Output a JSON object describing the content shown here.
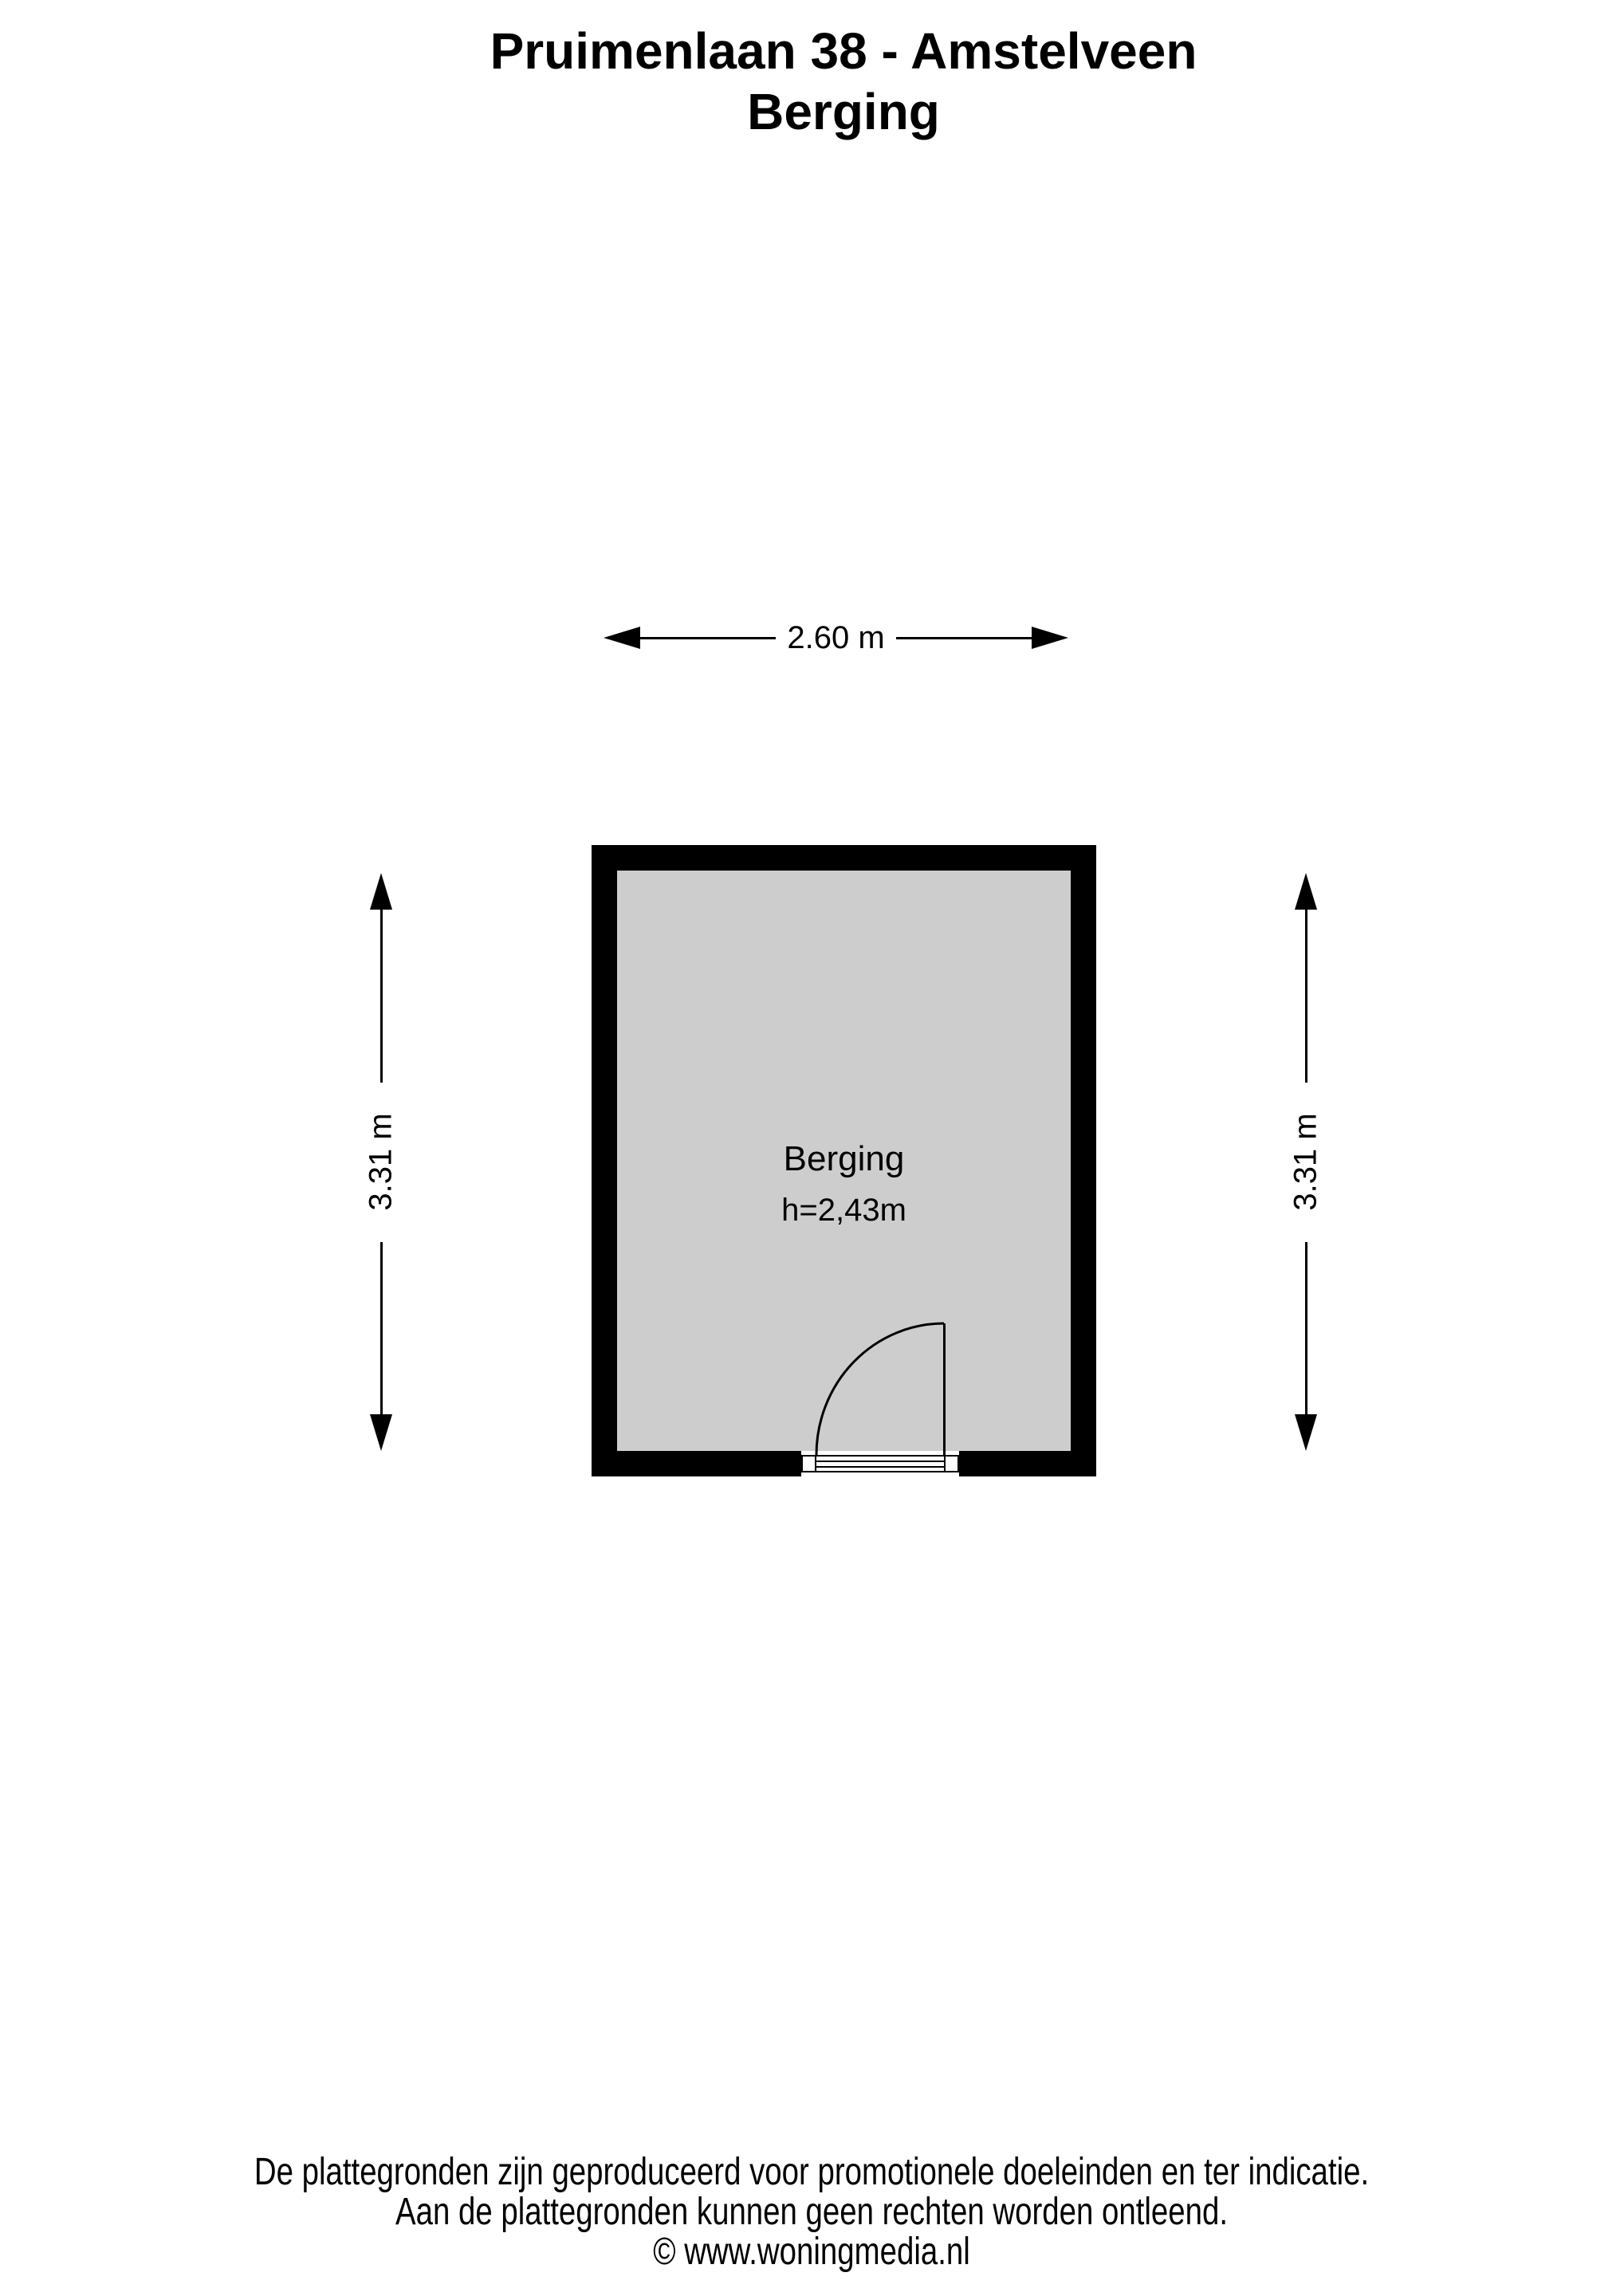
{
  "title": {
    "line1": "Pruimenlaan 38 - Amstelveen",
    "line2": "Berging"
  },
  "room": {
    "name": "Berging",
    "ceiling_height_label": "h=2,43m"
  },
  "dimensions": {
    "width_top": "2.60 m",
    "width_bottom": "2.60 m",
    "height_left": "3.31 m",
    "height_right": "3.31 m"
  },
  "footer": {
    "line1": "De plattegronden zijn geproduceerd voor promotionele doeleinden en ter indicatie.",
    "line2": "Aan de plattegronden kunnen geen rechten worden ontleend.",
    "line3": "© www.woningmedia.nl"
  },
  "colors": {
    "background": "#ffffff",
    "wall": "#000000",
    "floor_fill": "#cdcdcd",
    "text": "#000000"
  }
}
